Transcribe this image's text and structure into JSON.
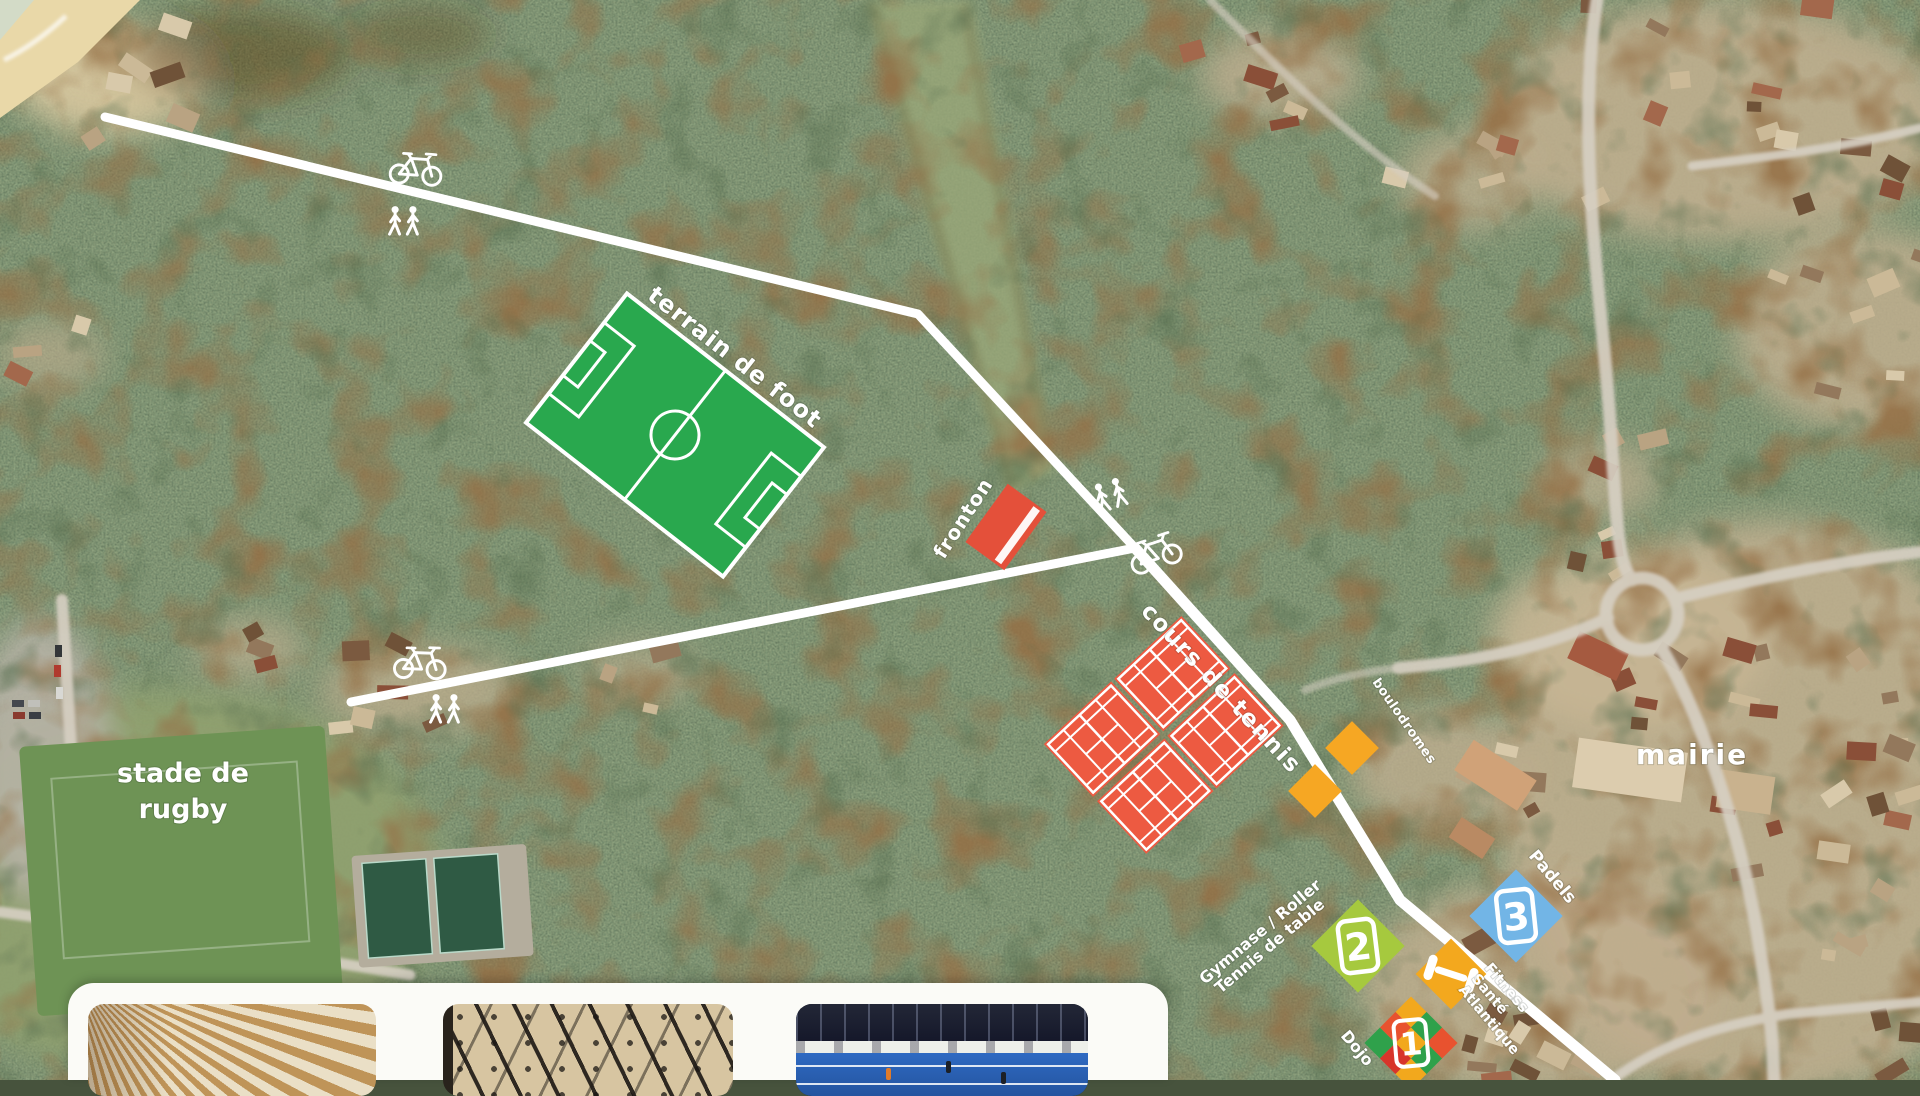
{
  "map": {
    "labels": {
      "terrain_de_foot": "terrain de foot",
      "fronton": "fronton",
      "cours_de_tennis": "cours de tennis",
      "boulodromes": "boulodromes",
      "stade_de_rugby": [
        "stade de",
        "rugby"
      ],
      "mairie": "mairie",
      "padels": "Padels",
      "gymnase_line1": "Gymnase / Roller",
      "gymnase_line2": "Tennis de table",
      "fitness_line1": "Fitness",
      "fitness_line2": "Santé",
      "fitness_line3": "Atlantique",
      "dojo": "Dojo"
    },
    "markers": [
      {
        "number": "1",
        "label": "Dojo",
        "style": "multicolor-checker"
      },
      {
        "number": "2",
        "label": "Gymnase / Roller – Tennis de table",
        "color": "#a6c93e"
      },
      {
        "number": "3",
        "label": "Padels",
        "color": "#72b5e6"
      }
    ],
    "facilities": [
      {
        "name": "terrain de foot",
        "color": "#29a84e"
      },
      {
        "name": "fronton",
        "color": "#e4503a"
      },
      {
        "name": "cours de tennis",
        "count": 4,
        "color": "#ed5a41"
      },
      {
        "name": "boulodromes",
        "count": 2,
        "color": "#f6a723"
      },
      {
        "name": "fitness",
        "color": "#f3a81e",
        "icon": "dumbbell-icon"
      },
      {
        "name": "stade de rugby"
      },
      {
        "name": "mairie"
      }
    ],
    "icons": [
      {
        "name": "bicycle-icon",
        "count": 3
      },
      {
        "name": "pedestrians-icon",
        "count": 3
      },
      {
        "name": "dumbbell-icon",
        "count": 1
      }
    ],
    "colors": {
      "path_white": "#ffffff",
      "field_green": "#29a84e",
      "court_orange": "#ed5a41",
      "boulodrome_yellow": "#f6a723",
      "marker2_green": "#a6c93e",
      "marker3_blue": "#72b5e6",
      "fitness_orange": "#f3a81e"
    }
  },
  "photos": [
    {
      "name": "gymnase-wood-ceiling"
    },
    {
      "name": "hall-interior-trusses"
    },
    {
      "name": "indoor-padel-court"
    }
  ]
}
